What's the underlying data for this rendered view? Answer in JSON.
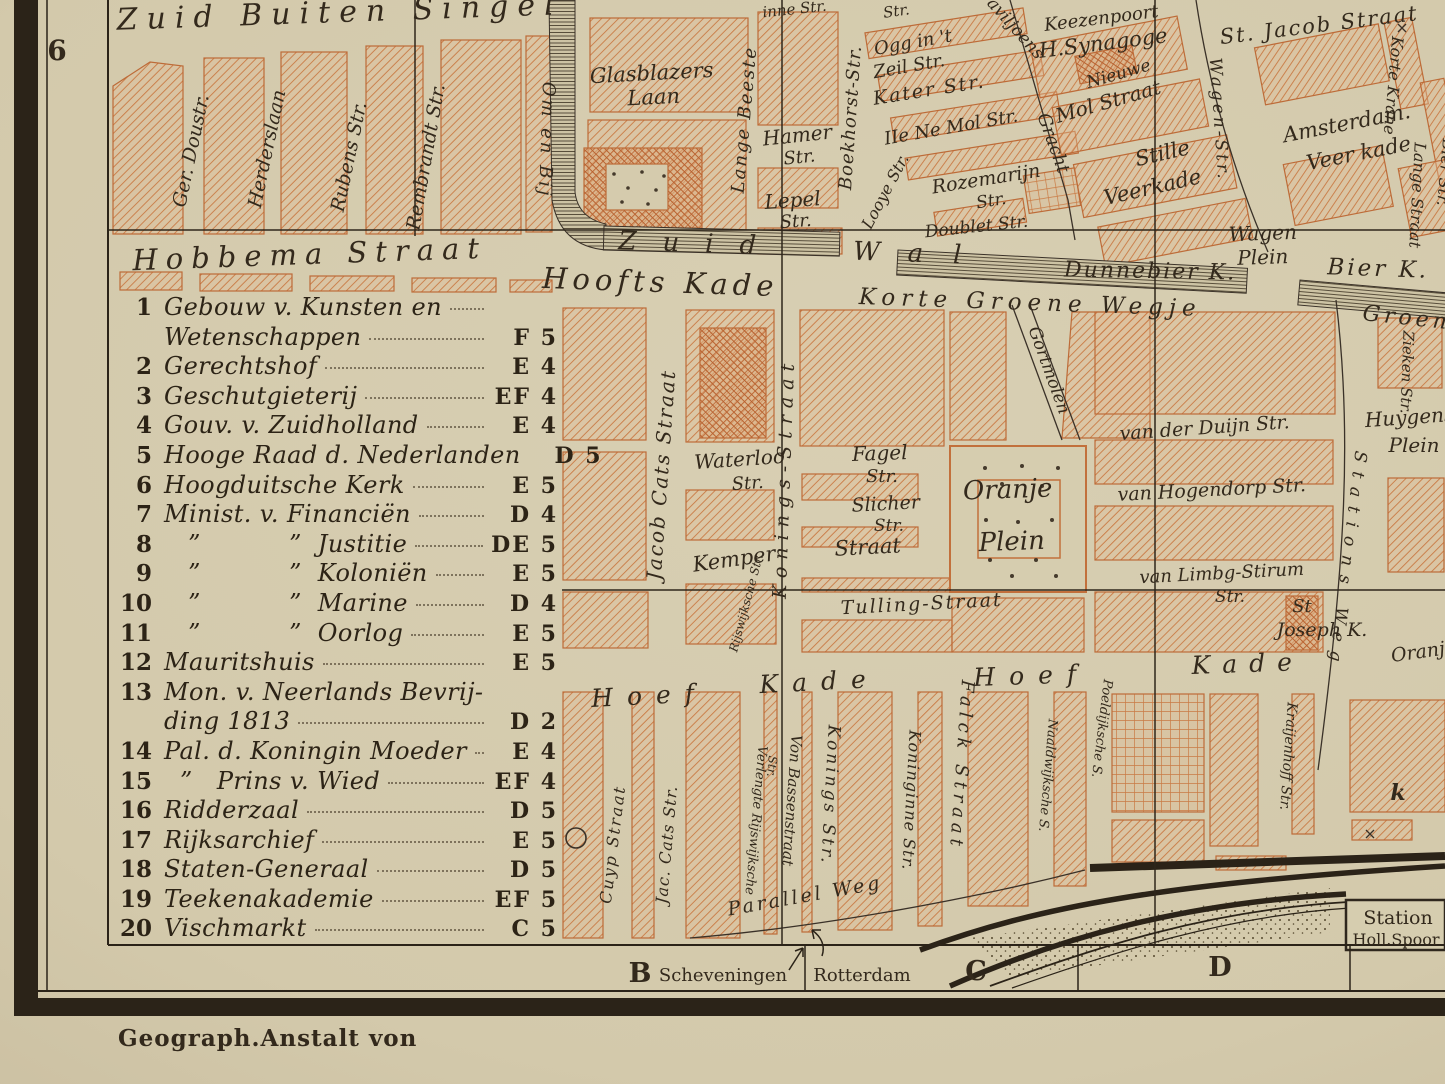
{
  "margin": {
    "row_label": "6",
    "col_b": "B",
    "col_c": "C",
    "col_d": "D",
    "dest_scheveningen": "Scheveningen",
    "dest_rotterdam": "Rotterdam",
    "credit": "Geograph.Anstalt von"
  },
  "legend": {
    "rows": [
      {
        "num": "1",
        "text": "Gebouw v. Kunsten en",
        "grid": ""
      },
      {
        "num": "",
        "text": "Wetenschappen",
        "grid": "F 5"
      },
      {
        "num": "2",
        "text": "Gerechtshof",
        "grid": "E 4"
      },
      {
        "num": "3",
        "text": "Geschutgieterij",
        "grid": "EF 4"
      },
      {
        "num": "4",
        "text": "Gouv. v. Zuidholland",
        "grid": "E 4"
      },
      {
        "num": "5",
        "text": "Hooge Raad d. Nederlanden",
        "grid": "D 5"
      },
      {
        "num": "6",
        "text": "Hoogduitsche Kerk",
        "grid": "E 5"
      },
      {
        "num": "7",
        "text": "Minist. v. Financiën",
        "grid": "D 4"
      },
      {
        "num": "8",
        "text": "   ”           ”  Justitie",
        "grid": "DE 5"
      },
      {
        "num": "9",
        "text": "   ”           ”  Koloniën",
        "grid": "E 5"
      },
      {
        "num": "10",
        "text": "   ”           ”  Marine",
        "grid": "D 4"
      },
      {
        "num": "11",
        "text": "   ”           ”  Oorlog",
        "grid": "E 5"
      },
      {
        "num": "12",
        "text": "Mauritshuis",
        "grid": "E 5"
      },
      {
        "num": "13",
        "text": "Mon. v. Neerlands Bevrij-",
        "grid": ""
      },
      {
        "num": "",
        "text": "ding 1813",
        "grid": "D 2"
      },
      {
        "num": "14",
        "text": "Pal. d. Koningin Moeder",
        "grid": "E 4"
      },
      {
        "num": "15",
        "text": "  ”   Prins v. Wied",
        "grid": "EF 4"
      },
      {
        "num": "16",
        "text": "Ridderzaal",
        "grid": "D 5"
      },
      {
        "num": "17",
        "text": "Rijksarchief",
        "grid": "E 5"
      },
      {
        "num": "18",
        "text": "Staten-Generaal",
        "grid": "D 5"
      },
      {
        "num": "19",
        "text": "Teekenakademie",
        "grid": "EF 5"
      },
      {
        "num": "20",
        "text": "Vischmarkt",
        "grid": "C 5"
      }
    ]
  },
  "map": {
    "labels": {
      "zuid_buiten_singel": "Zuid Buiten Singel",
      "ger_doustr": "Ger. Doustr.",
      "herderslaan": "Herderslaan",
      "rubens": "Rubens Str.",
      "rembrandt": "Rembrandt Str.",
      "hobbema": "Hobbema Straat",
      "om_en_bij": "Om en Bij",
      "glasblazers1": "Glasblazers",
      "glasblazers2": "Laan",
      "lange_beesten": "Lange Beeste",
      "binnen": "inne Str.",
      "hamer1": "Hamer",
      "hamer2": "Str.",
      "lepel1": "Lepel",
      "lepel2": "Str.",
      "boekhorst": "Boekhorst-Str.",
      "zuid": "Zuid",
      "wal": "Wal",
      "hoofts_kade": "Hoofts Kade",
      "korte_groene": "Korte Groene Wegje",
      "str_top": "Str.",
      "ogg1": "Ogg in 't",
      "ogg2": "Zeil Str.",
      "kater": "Kater Str.",
      "mol": "IIe Ne Mol Str.",
      "looye": "Looye Str.",
      "rozemarijn1": "Rozemarijn",
      "rozemarijn2": "Str.",
      "doublet": "Doublet Str.",
      "paviljoens": "Paviljoens",
      "gracht": "Gracht",
      "keezenpoort": "Keezenpoort",
      "synagoge": "H.Synagoge",
      "nieuwe": "Nieuwe",
      "mol_straat": "Mol Straat",
      "st_jacob": "St. Jacob Straat",
      "wagen_str": "Wagen-Str.",
      "stille": "Stille",
      "veerkade": "Veerkade",
      "amsterdam": "Amsterdam.",
      "veer_kade": "Veer kade",
      "korte_krane": "Korte Krane",
      "lange_straat": "Lange Straat",
      "bier_str": "Bier Str.",
      "wagen_plein1": "Wagen",
      "wagen_plein2": "Plein",
      "dunnebier": "Dunnebier K.",
      "bier_k": "Bier K.",
      "groene_wegje": "Groene Wegje",
      "jacob_cats": "Jacob Cats Straat",
      "konings": "Konings-Straat",
      "waterloo1": "Waterloo",
      "waterloo2": "Str.",
      "fagel1": "Fagel",
      "fagel2": "Str.",
      "slicher1": "Slicher",
      "slicher2": "Str.",
      "kemper": "Kemper",
      "kemper_straat": "Straat",
      "rijswijksche": "Rijswijksche Str.",
      "gortmolen": "Gortmolen",
      "oranje": "Oranje",
      "oranje_plein": "Plein",
      "tulling": "Tulling-Straat",
      "vd_duijn": "van der Duijn Str.",
      "v_hogendorp": "van Hogendorp Str.",
      "v_limbg1": "van Limbg-Stirum",
      "v_limbg2": "Str.",
      "st1": "St",
      "st2": "Joseph K.",
      "huygens1": "Huygens",
      "huygens2": "Plein",
      "zieken": "Zieken Str.",
      "stations_weg": "Stations Weg",
      "hoef_w": "Hoef",
      "kade_w": "Kade",
      "hoef_e": "Hoef",
      "kade_e": "Kade",
      "cuyp": "Cuyp Straat",
      "jac_cats": "Jac. Cats Str.",
      "verlengte": "Verlengte Rijswijksche",
      "verlengte_str": "Str.",
      "von_bassen": "Von Bassenstraat",
      "konings_s": "Konings Str.",
      "koninginne": "Koninginne Str.",
      "falck": "Falck Straat",
      "naaldwijksche": "Naaldwijksche S.",
      "poeldijksche": "Poeldijksche S.",
      "kraijenhoff": "Kraijenhoff Str.",
      "k_mark": "k",
      "parallel_weg": "Parallel Weg",
      "oranje_edge": "Oranje",
      "station1": "Station",
      "station2": "Holl.Spoor"
    }
  }
}
